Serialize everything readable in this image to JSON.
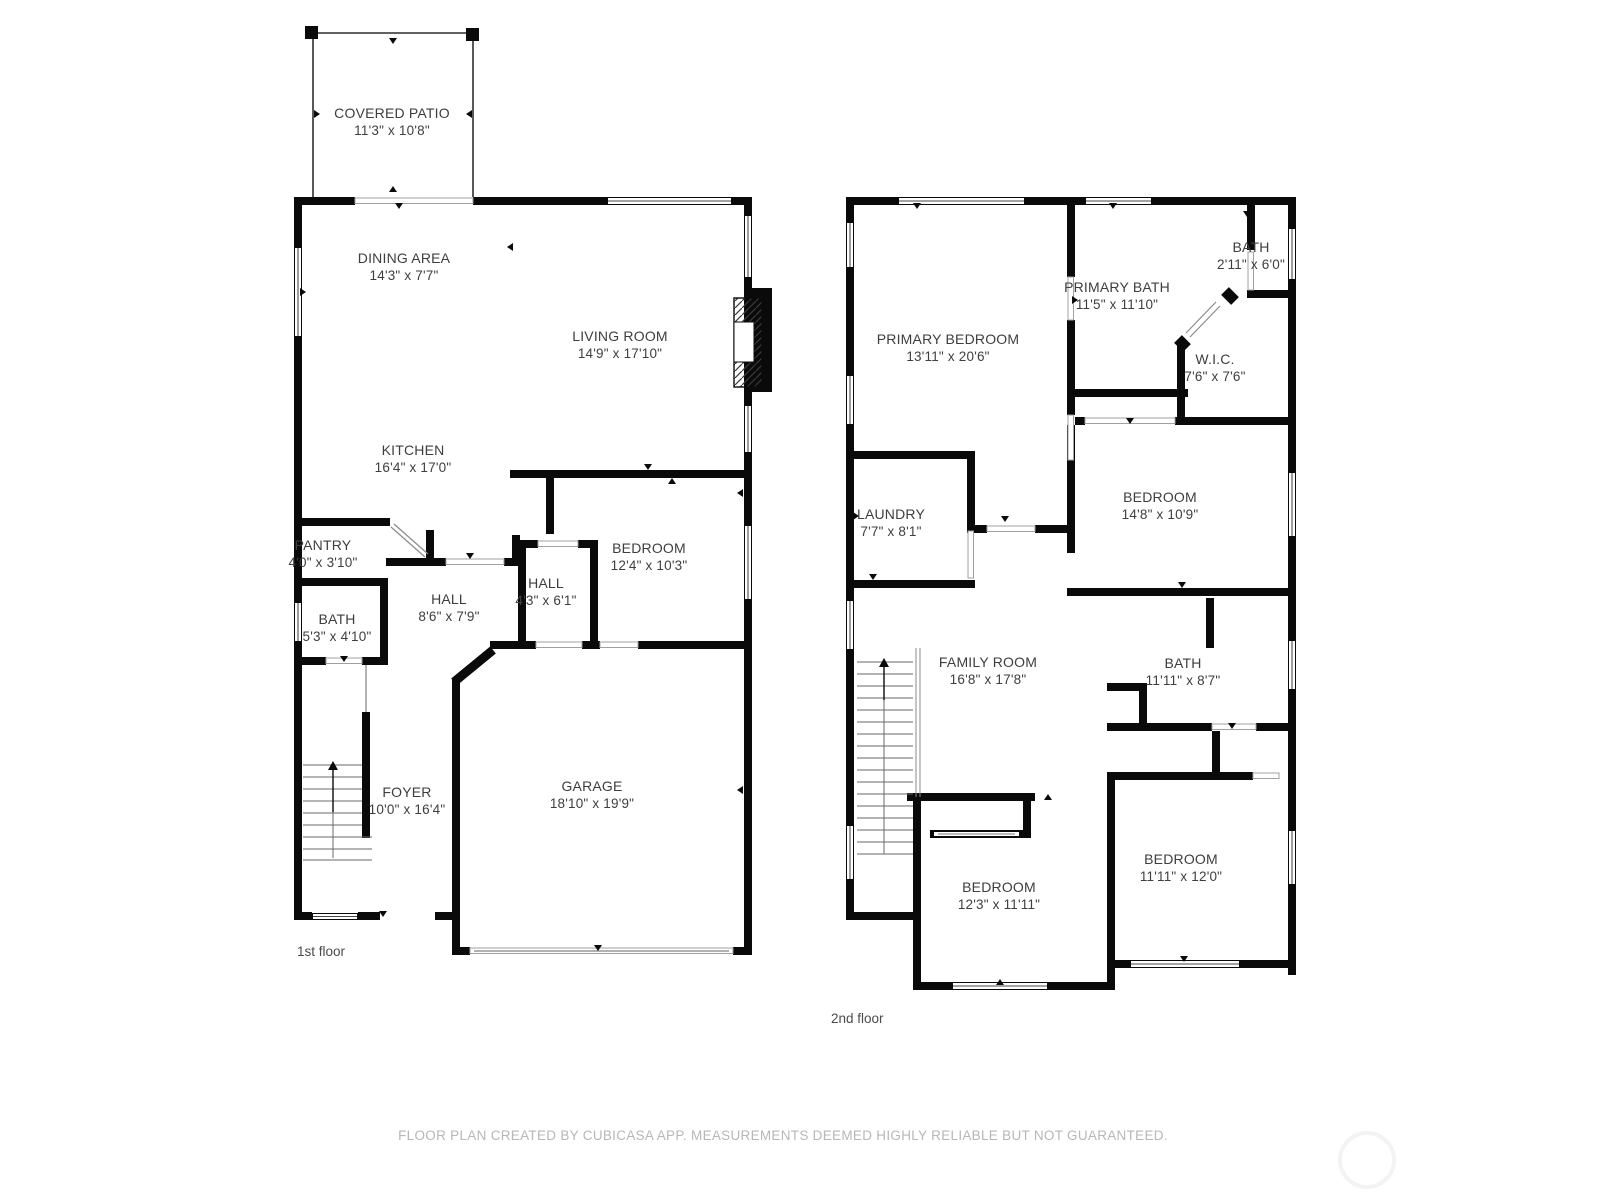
{
  "meta": {
    "app_footer": "FLOOR PLAN CREATED BY CUBICASA APP. MEASUREMENTS DEEMED HIGHLY RELIABLE BUT NOT GUARANTEED.",
    "colors": {
      "wall": "#0a0a0a",
      "room_text": "#3e3e3e",
      "footer_text": "#b7b7b7",
      "background": "#ffffff"
    }
  },
  "floors": [
    {
      "label": "1st floor",
      "rooms": [
        {
          "name": "COVERED PATIO",
          "dims": "11'3\" x 10'8\""
        },
        {
          "name": "DINING AREA",
          "dims": "14'3\" x 7'7\""
        },
        {
          "name": "LIVING ROOM",
          "dims": "14'9\" x 17'10\""
        },
        {
          "name": "KITCHEN",
          "dims": "16'4\" x 17'0\""
        },
        {
          "name": "PANTRY",
          "dims": "4'0\" x 3'10\""
        },
        {
          "name": "BATH",
          "dims": "5'3\" x 4'10\""
        },
        {
          "name": "HALL",
          "dims": "8'6\" x 7'9\""
        },
        {
          "name": "HALL",
          "dims": "4'3\" x 6'1\""
        },
        {
          "name": "BEDROOM",
          "dims": "12'4\" x 10'3\""
        },
        {
          "name": "FOYER",
          "dims": "10'0\" x 16'4\""
        },
        {
          "name": "GARAGE",
          "dims": "18'10\" x 19'9\""
        }
      ]
    },
    {
      "label": "2nd floor",
      "rooms": [
        {
          "name": "PRIMARY BEDROOM",
          "dims": "13'11\" x 20'6\""
        },
        {
          "name": "PRIMARY BATH",
          "dims": "11'5\" x 11'10\""
        },
        {
          "name": "BATH",
          "dims": "2'11\" x 6'0\""
        },
        {
          "name": "W.I.C.",
          "dims": "7'6\" x 7'6\""
        },
        {
          "name": "BEDROOM",
          "dims": "14'8\" x 10'9\""
        },
        {
          "name": "LAUNDRY",
          "dims": "7'7\" x 8'1\""
        },
        {
          "name": "FAMILY ROOM",
          "dims": "16'8\" x 17'8\""
        },
        {
          "name": "BATH",
          "dims": "11'11\" x 8'7\""
        },
        {
          "name": "BEDROOM",
          "dims": "12'3\" x 11'11\""
        },
        {
          "name": "BEDROOM",
          "dims": "11'11\" x 12'0\""
        }
      ]
    }
  ]
}
